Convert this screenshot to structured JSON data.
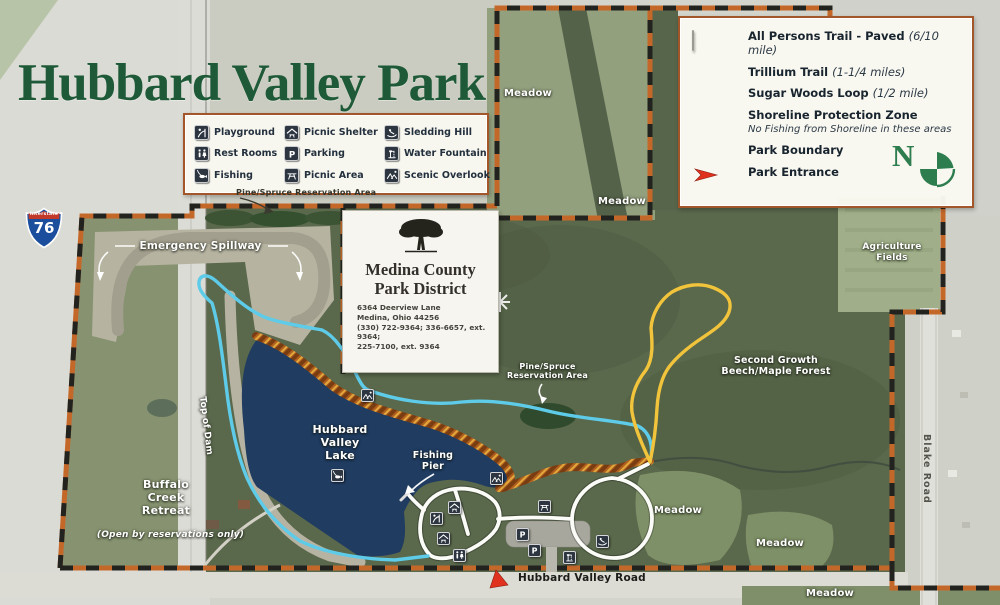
{
  "title": "Hubbard Valley Park",
  "facilities_legend": {
    "items": [
      {
        "icon": "playground-icon",
        "label": "Playground"
      },
      {
        "icon": "picnic-shelter-icon",
        "label": "Picnic Shelter"
      },
      {
        "icon": "sledding-hill-icon",
        "label": "Sledding Hill"
      },
      {
        "icon": "rest-rooms-icon",
        "label": "Rest Rooms"
      },
      {
        "icon": "parking-icon",
        "label": "Parking"
      },
      {
        "icon": "water-fountain-icon",
        "label": "Water Fountain"
      },
      {
        "icon": "fishing-icon",
        "label": "Fishing"
      },
      {
        "icon": "picnic-area-icon",
        "label": "Picnic Area"
      },
      {
        "icon": "scenic-overlook-icon",
        "label": "Scenic Overlook"
      }
    ]
  },
  "trail_legend": {
    "items": [
      {
        "label": "All Persons Trail - Paved",
        "detail": "(6/10 mile)",
        "swatch": "white-bar",
        "color": "#ffffff"
      },
      {
        "label": "Trillium Trail",
        "detail": "(1-1/4 miles)",
        "swatch": "blue-bar",
        "color": "#5bc8e8"
      },
      {
        "label": "Sugar Woods Loop",
        "detail": "(1/2 mile)",
        "swatch": "yellow-bar",
        "color": "#f2c53d"
      },
      {
        "label": "Shoreline Protection Zone",
        "note": "No Fishing from Shoreline in these areas",
        "swatch": "striped"
      },
      {
        "label": "Park Boundary",
        "swatch": "boundary"
      },
      {
        "label": "Park Entrance",
        "swatch": "red-arrow",
        "color": "#e0301e"
      }
    ],
    "compass_letter": "N"
  },
  "park_district": {
    "name_line1": "Medina County",
    "name_line2": "Park District",
    "address_line1": "6364 Deerview Lane",
    "address_line2": "Medina, Ohio 44256",
    "address_line3": "(330) 722-9364; 336-6657, ext. 9364;",
    "address_line4": "225-7100, ext. 9364"
  },
  "highway_shield": {
    "system": "Interstate",
    "route": "76"
  },
  "map_labels": {
    "pine_spruce_top": "Pine/Spruce Reservation Area",
    "emergency_spillway": "Emergency Spillway",
    "hubbard_valley_lake": "Hubbard Valley Lake",
    "top_of_dam": "Top of Dam",
    "buffalo_creek_retreat": "Buffalo Creek Retreat",
    "buffalo_creek_note": "(Open by reservations only)",
    "fishing_pier": "Fishing Pier",
    "pine_spruce_mid": "Pine/Spruce Reservation Area",
    "meadow": "Meadow",
    "second_growth": "Second Growth Beech/Maple Forest",
    "agriculture_fields": "Agriculture Fields",
    "blake_road": "Blake Road",
    "hubbard_valley_road": "Hubbard Valley Road"
  },
  "colors": {
    "title_green": "#1e5a38",
    "lake_blue": "#203c61",
    "boundary_orange": "#c4682a",
    "trillium_blue": "#5ecbe9",
    "sugar_yellow": "#f1c43c",
    "entrance_red": "#e0301e"
  }
}
